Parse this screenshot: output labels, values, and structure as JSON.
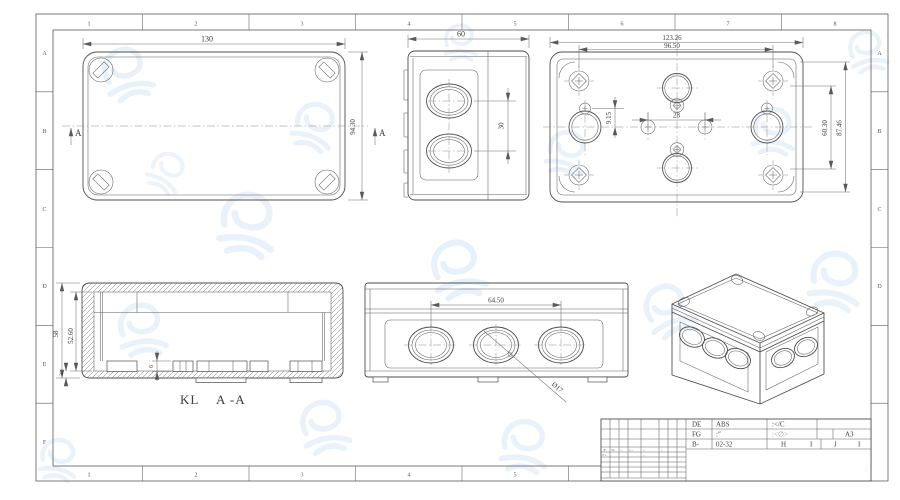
{
  "colors": {
    "line": "#4f4f4f",
    "watermark": "#d3e6f6"
  },
  "zones": {
    "top": [
      "1",
      "2",
      "3",
      "4",
      "5",
      "6",
      "7",
      "8"
    ],
    "bottom": [
      "1",
      "2",
      "3",
      "4",
      "5"
    ],
    "left": [
      "A",
      "B",
      "C",
      "D",
      "E",
      "F"
    ],
    "right": [
      "A",
      "B",
      "C",
      "D"
    ]
  },
  "top_view": {
    "width_dim": "130",
    "height_dim": "94.30",
    "section_left": "A",
    "section_right": "A"
  },
  "side_view": {
    "width_dim": "60",
    "spacing_dim": "30"
  },
  "bottom_view": {
    "outer_width_dim": "123.26",
    "screw_width_dim": "96.50",
    "inner_height_dim": "60.30",
    "outer_height_dim": "87.46",
    "offset_dim": "9.15",
    "center_spacing_dim": "28"
  },
  "section_view": {
    "outer_height_dim": "58",
    "inner_height_dim": "52.60",
    "boss_dim": "6",
    "rim_dim": "3",
    "label": "KL",
    "section_name": "A -A"
  },
  "front_view": {
    "spacing_dim": "64.50",
    "diameter_label": "Ø17"
  },
  "title_block": {
    "r1c1": "DE",
    "r1c2": "ABS",
    "r1c3": ":</C",
    "r2c1": "FG",
    "r2c2": ":″",
    "r2c3": ":<∅>",
    "r2c5": "A3",
    "r3c1": "B-",
    "r3c2": "02-32",
    "r3c3": "H",
    "r3c4": "I",
    "r3c5": "J",
    "r3c6": "I"
  },
  "revision_marks": [
    "-E",
    "N-",
    ":-",
    "(--",
    "/-",
    "|",
    "01",
    "--",
    "·",
    "·"
  ]
}
